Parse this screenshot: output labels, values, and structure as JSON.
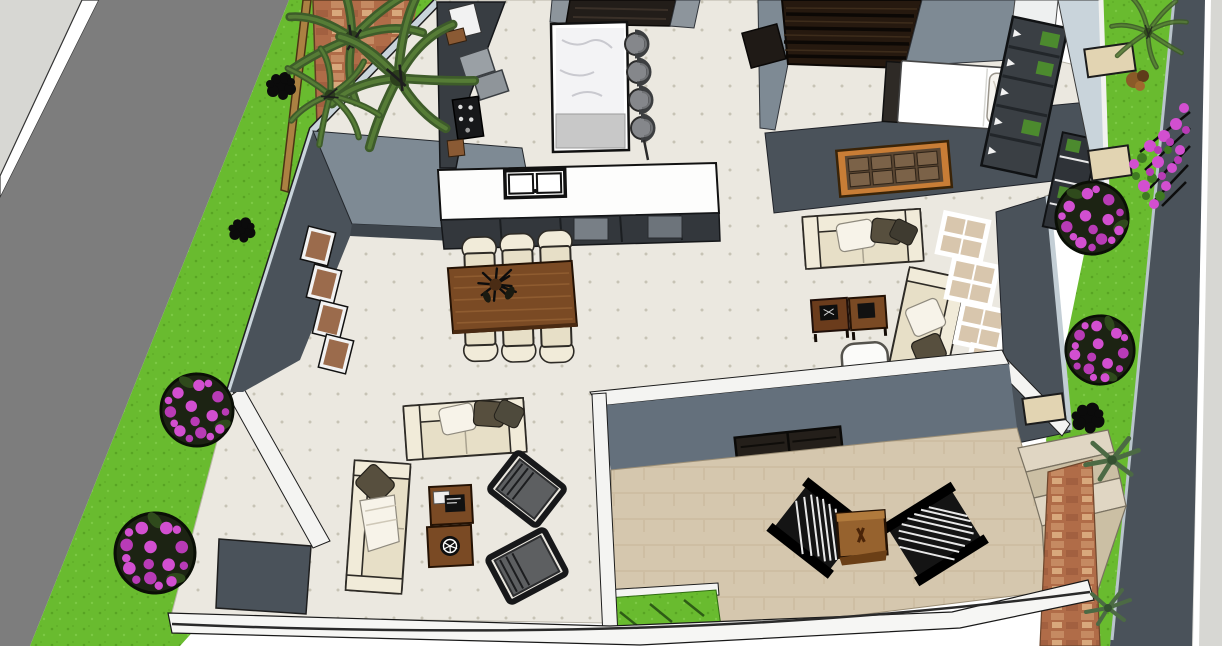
{
  "app": {
    "type": "3d-architectural-render",
    "description": "Aerial SketchUp-style rendering of a modern single-storey house model: open-plan kitchen, dining and living areas, a family room, a bedroom, a rear patio with lounge chairs, and street landscaping with palms and flowering topiary bushes",
    "view": "top-down perspective, no application chrome, no visible text"
  },
  "palette": {
    "bg": "#ffffff",
    "sidewalk": "#d7d7d3",
    "road": "#7d7d7d",
    "roadLine": "#ffffff",
    "grass": "#69bb2f",
    "grassDark": "#58a423",
    "fence": "#ab8142",
    "brick": "#b06c48",
    "brickLight": "#c58a62",
    "palmDark": "#3e5c2a",
    "palmMid": "#567c36",
    "palmLight": "#6f9a47",
    "wallTop": "#7e8a94",
    "wallSide": "#4a525a",
    "wallSideDark": "#3d444b",
    "wallLight": "#c9d4db",
    "wallFace": "#64707c",
    "white": "#f4f4f2",
    "tile": "#ebe8e0",
    "tileDot": "#c7c3b5",
    "patio": "#d5c7ae",
    "counterDark": "#383d42",
    "cabinetDark": "#33373c",
    "cabinetTop": "#221d19",
    "counterWhite": "#fdfdfc",
    "marble": "#f3f3f5",
    "stool": "#85878b",
    "wood": "#7a4a24",
    "woodLight": "#8f5c30",
    "woodDark": "#4a2a12",
    "cream": "#e7dfc7",
    "creamLight": "#f1ebd9",
    "pillowWhite": "#f7f3e9",
    "pillowDark": "#574f3e",
    "charGray": "#5d5f61",
    "charFrame": "#17181a",
    "loungeBlack": "#141414",
    "slatWhite": "#e8e8e8",
    "pink": "#d24fd0",
    "pinkDark": "#b83bb6",
    "bushBase": "#1c2313",
    "artFrame": "#c87d36",
    "artInner": "#7b6248",
    "bedWhite": "#ffffff",
    "wardrobe": "#3a3f44",
    "plantGreen": "#4c8a2e",
    "doorDark": "#241f1a",
    "stepLight": "#e0d6c3",
    "stepMid": "#cbbfa4",
    "ceilingDark": "#26190f"
  },
  "scene": {
    "exterior": [
      {
        "name": "street",
        "label": "asphalt road running diagonally on the left"
      },
      {
        "name": "sidewalk-left",
        "label": "light concrete sidewalk, far left"
      },
      {
        "name": "grass-verge-left",
        "label": "lawn strip with shrubs and two pink flowering topiary bushes"
      },
      {
        "name": "brick-path",
        "label": "terracotta brick path with two palm trees, top left"
      },
      {
        "name": "garden-right",
        "label": "side yard with stepping stones, topiary, bougainvillea and palms"
      },
      {
        "name": "boundary-wall-right",
        "label": "dark boundary wall with sidewalk beyond, far right"
      }
    ],
    "rooms": [
      {
        "name": "kitchen",
        "furniture": [
          "wall counters with appliances",
          "marble island",
          "4 bar stools",
          "sink counter with double sink",
          "dark base cabinets"
        ]
      },
      {
        "name": "dining-area",
        "furniture": [
          "wooden dining table",
          "6 cream chairs",
          "dark floral centerpiece"
        ]
      },
      {
        "name": "living-room",
        "furniture": [
          "2 cream sofas with pillows",
          "2 wooden coffee tables",
          "2 dark armchairs"
        ]
      },
      {
        "name": "family-room",
        "furniture": [
          "2 cream sofas",
          "2 wooden side tables",
          "white pouf",
          "tall window column"
        ]
      },
      {
        "name": "bedroom",
        "furniture": [
          "white double bed",
          "dark wardrobe with shelves",
          "slatted dark ceiling",
          "framed wall art"
        ]
      },
      {
        "name": "patio",
        "furniture": [
          "2 black slatted lounge chairs",
          "wooden cube table",
          "dark double door",
          "window",
          "lawn patch",
          "garden steps"
        ]
      }
    ]
  }
}
